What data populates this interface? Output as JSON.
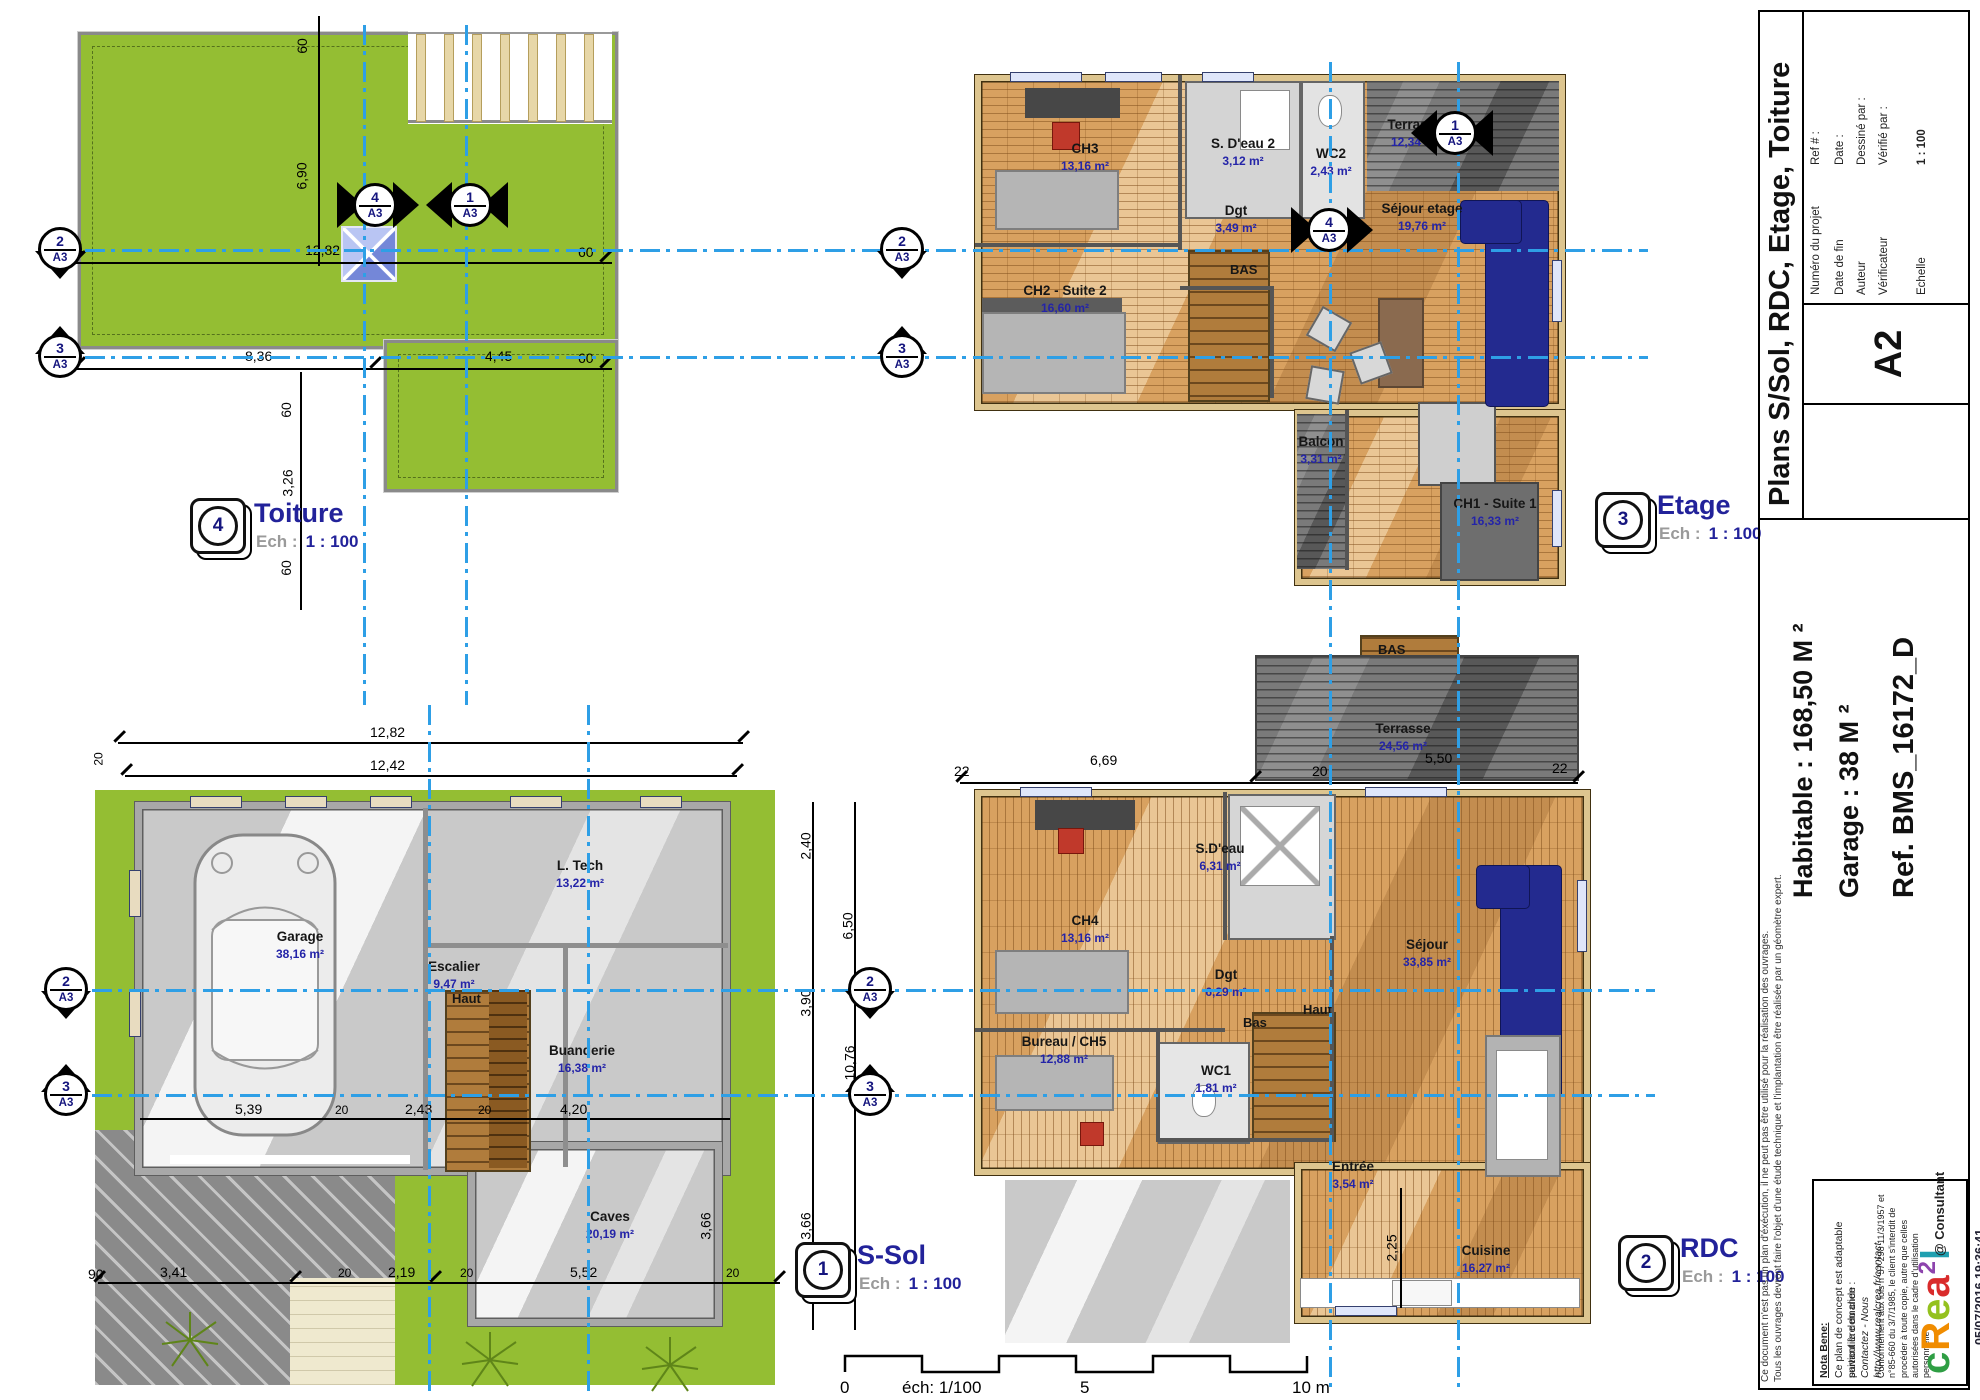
{
  "sheet": {
    "scale_bar": {
      "zero": "0",
      "label": "éch: 1/100",
      "five": "5",
      "ten": "10 m"
    },
    "datetime": "05/07/2016 19:36:41"
  },
  "markers": {
    "m1": {
      "num": "1",
      "ref": "A3"
    },
    "m2": {
      "num": "2",
      "ref": "A3"
    },
    "m3": {
      "num": "3",
      "ref": "A3"
    },
    "m4": {
      "num": "4",
      "ref": "A3"
    }
  },
  "plans": {
    "toiture": {
      "icon_num": "4",
      "title": "Toiture",
      "ech_label": "Ech :",
      "ech_value": "1 : 100",
      "dims": {
        "top60": "60",
        "h690": "6,90",
        "l1": [
          "60",
          "12,82",
          "60"
        ],
        "l2": [
          "60",
          "8,36",
          "4,45",
          "60"
        ],
        "step": [
          "60",
          "3,26",
          "60"
        ]
      }
    },
    "etage": {
      "icon_num": "3",
      "title": "Etage",
      "ech_label": "Ech :",
      "ech_value": "1 : 100",
      "bas": "BAS",
      "rooms": [
        {
          "name": "CH3",
          "area": "13,16 m²"
        },
        {
          "name": "S. D'eau 2",
          "area": "3,12 m²"
        },
        {
          "name": "WC2",
          "area": "2,43 m²"
        },
        {
          "name": "Terrasse",
          "area": "12,34 m²"
        },
        {
          "name": "Dgt",
          "area": "3,49 m²"
        },
        {
          "name": "CH2 - Suite 2",
          "area": "16,60 m²"
        },
        {
          "name": "Séjour etage",
          "area": "19,76 m²"
        },
        {
          "name": "Balcon",
          "area": "3,31 m²"
        },
        {
          "name": "CH1 - Suite 1",
          "area": "16,33 m²"
        }
      ]
    },
    "rdc": {
      "icon_num": "2",
      "title": "RDC",
      "ech_label": "Ech :",
      "ech_value": "1 : 100",
      "bas_top": "BAS",
      "bas": "Bas",
      "haut": "Haut",
      "rooms": [
        {
          "name": "Terrasse",
          "area": "24,56 m²"
        },
        {
          "name": "S.D'eau",
          "area": "6,31 m²"
        },
        {
          "name": "CH4",
          "area": "13,16 m²"
        },
        {
          "name": "Séjour",
          "area": "33,85 m²"
        },
        {
          "name": "Dgt",
          "area": "6,29 m²"
        },
        {
          "name": "Bureau / CH5",
          "area": "12,88 m²"
        },
        {
          "name": "WC1",
          "area": "1,81 m²"
        },
        {
          "name": "Entrée",
          "area": "3,54 m²"
        },
        {
          "name": "Cuisine",
          "area": "16,27 m²"
        }
      ],
      "dims": {
        "top": [
          "22",
          "6,69",
          "20",
          "5,50",
          "22"
        ],
        "v225": "2,25"
      }
    },
    "ssol": {
      "icon_num": "1",
      "title": "S-Sol",
      "ech_label": "Ech :",
      "ech_value": "1 : 100",
      "haut": "Haut",
      "rooms": [
        {
          "name": "Garage",
          "area": "38,16 m²"
        },
        {
          "name": "L. Tech",
          "area": "13,22 m²"
        },
        {
          "name": "Escalier",
          "area": "9,47 m²"
        },
        {
          "name": "Buanderie",
          "area": "16,38 m²"
        },
        {
          "name": "Caves",
          "area": "20,19 m²"
        }
      ],
      "dims": {
        "top": [
          "12,82",
          "12,42"
        ],
        "top20": "20",
        "bottom": [
          "90",
          "3,41",
          "20",
          "2,19",
          "20",
          "5,52",
          "20"
        ],
        "inner": [
          "5,39",
          "20",
          "2,43",
          "20",
          "4,20"
        ],
        "right": [
          "2,40",
          "3,90",
          "3,66",
          "6,50",
          "10,76",
          "3,66"
        ]
      }
    }
  },
  "title_block": {
    "title": "Plans S/Sol, RDC, Etage, Toiture",
    "format": "A2",
    "fields": [
      {
        "label": "Numéro du projet",
        "value": "Ref # :"
      },
      {
        "label": "Date de fin",
        "value": "Date :"
      },
      {
        "label": "Auteur",
        "value": "Dessiné par :"
      },
      {
        "label": "Vérificateur",
        "value": "Vérifié par :"
      }
    ],
    "scale_label": "Echelle",
    "scale_value": "1 : 100",
    "habitable": "Habitable : 168,50 M ²",
    "garage": "Garage : 38 M ²",
    "reference": "Ref. BMS_16172_D",
    "disclaimer1": "Ce document n'est pas un plan d'éxécution, il ne peut pas être utilisé pour la réalisation des ouvrages.",
    "disclaimer2": "Tous les ouvrages devront faire l'objet d'une étude technique et l'implantation être réalisée par un géomètre expert.",
    "nota_title": "Nota Bene:",
    "nota_line1": "Ce plan de concept est adaptable suivant la demande",
    "nota_line2": "particulière du clien :",
    "nota_line3": "Contactez - Nous http://www.realcrea.fr/contact",
    "legal": "Conformément aux lois n°57-298 11/3/1957 et n°85-660 du 3/7/1985, le client s'interdit de procéder à toute copie, autre que celles autorisées dans le cadre d'utilisation personnelle",
    "consultant": "@ Consultant",
    "logo_chars": [
      "c",
      "R",
      "e",
      "a",
      "2",
      "l"
    ],
    "logo_colors": [
      "#2f9e44",
      "#f08c00",
      "#94c11f",
      "#d92b2b",
      "#8d44ad",
      "#1f9fb0"
    ]
  },
  "colors": {
    "axis": "#2e9fe6",
    "grass": "#94be33",
    "label": "#2424a8"
  }
}
